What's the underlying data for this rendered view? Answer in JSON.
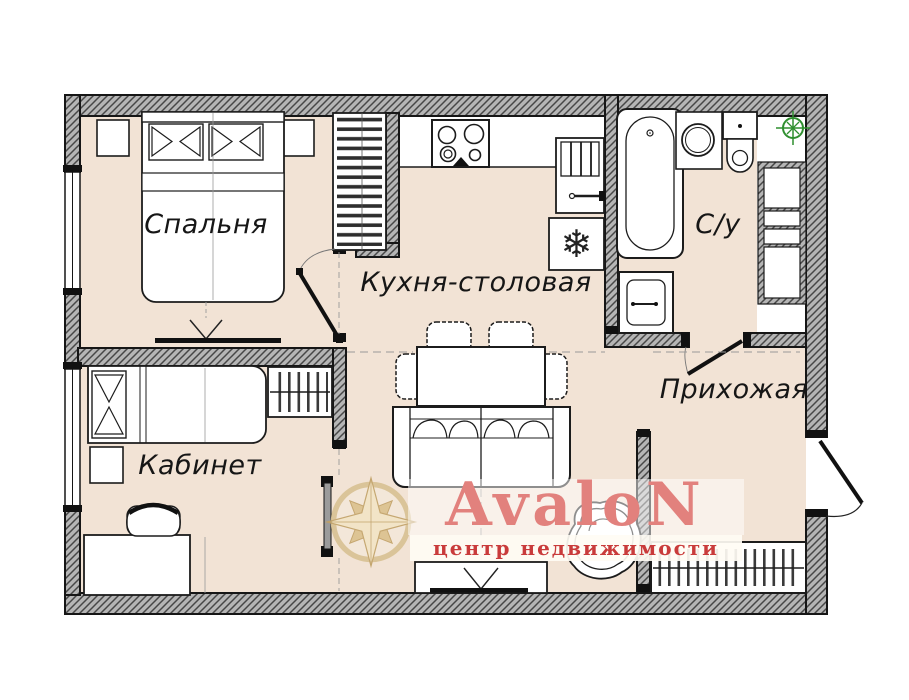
{
  "rooms": {
    "bedroom": {
      "label": "Спальня"
    },
    "kitchen_dining": {
      "label": "Кухня-столовая"
    },
    "bathroom": {
      "label": "С/у"
    },
    "hallway": {
      "label": "Прихожая"
    },
    "office": {
      "label": "Кабинет"
    }
  },
  "watermark": {
    "brand": "AvaloN",
    "tagline": "центр недвижимости"
  },
  "icons": {
    "freezer_snowflake": "❄"
  },
  "colors": {
    "floor": "#f2e3d5",
    "wall_fill": "#b5b5b5",
    "wall_hatch": "#474747",
    "outline": "#1c1c1c",
    "brand_pink": "#e2817d",
    "brand_red": "#c93b3b",
    "brand_gold": "#d9c294",
    "vent_green": "#2f8f2f"
  }
}
